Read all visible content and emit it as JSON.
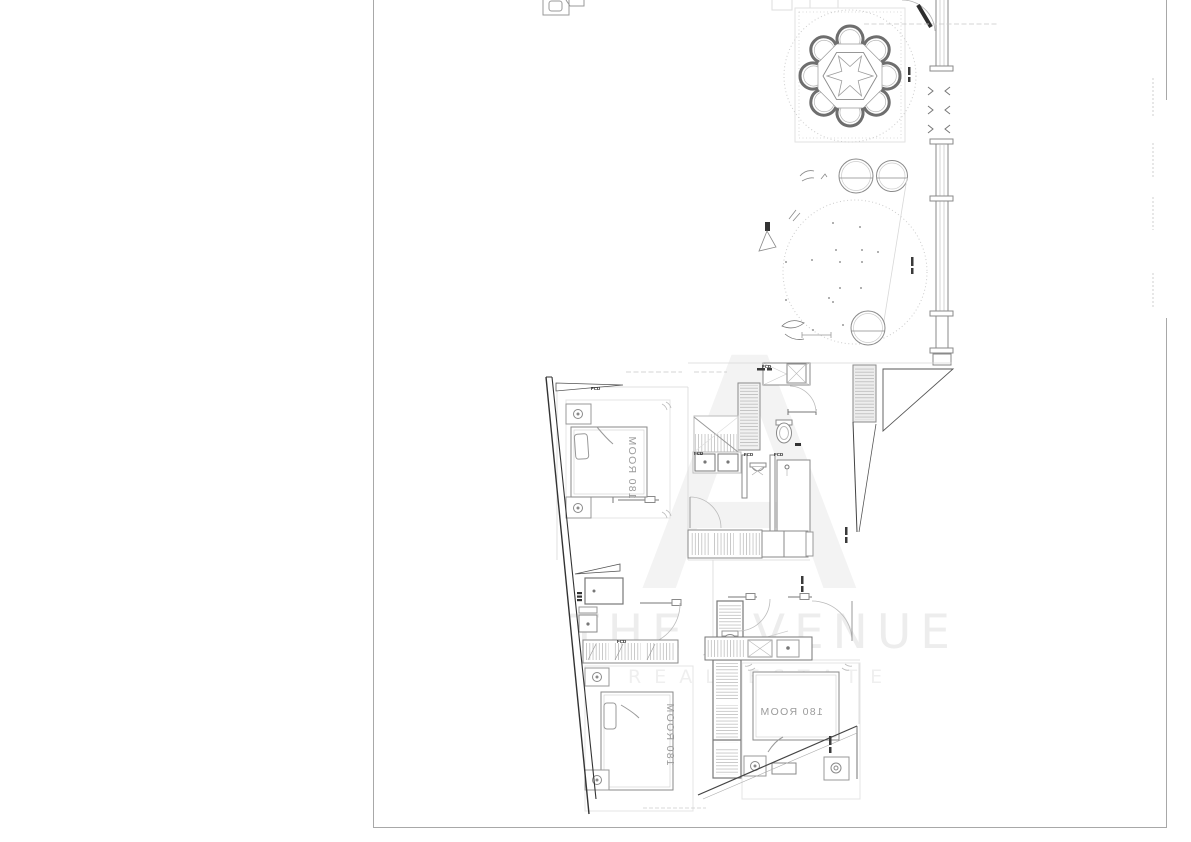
{
  "sheet": {
    "background": "#ffffff",
    "border_color": "#a8a8a8"
  },
  "watermark": {
    "logo_letter": "A",
    "line1": "THE AVENUE",
    "line2": "REAL ESTATE",
    "color": "#efefef"
  },
  "rooms": {
    "bedroom_top_label": "180 ROOM",
    "bedroom_bottom_left_label": "180 ROOM",
    "bedroom_bottom_right_label": "180 ROOM"
  },
  "tags": {
    "door_tag": "FCD"
  },
  "colors": {
    "wall_dark": "#3a3a3a",
    "line": "#8a8a8a",
    "line_light": "#cccccc",
    "label": "#9b9b9b"
  }
}
